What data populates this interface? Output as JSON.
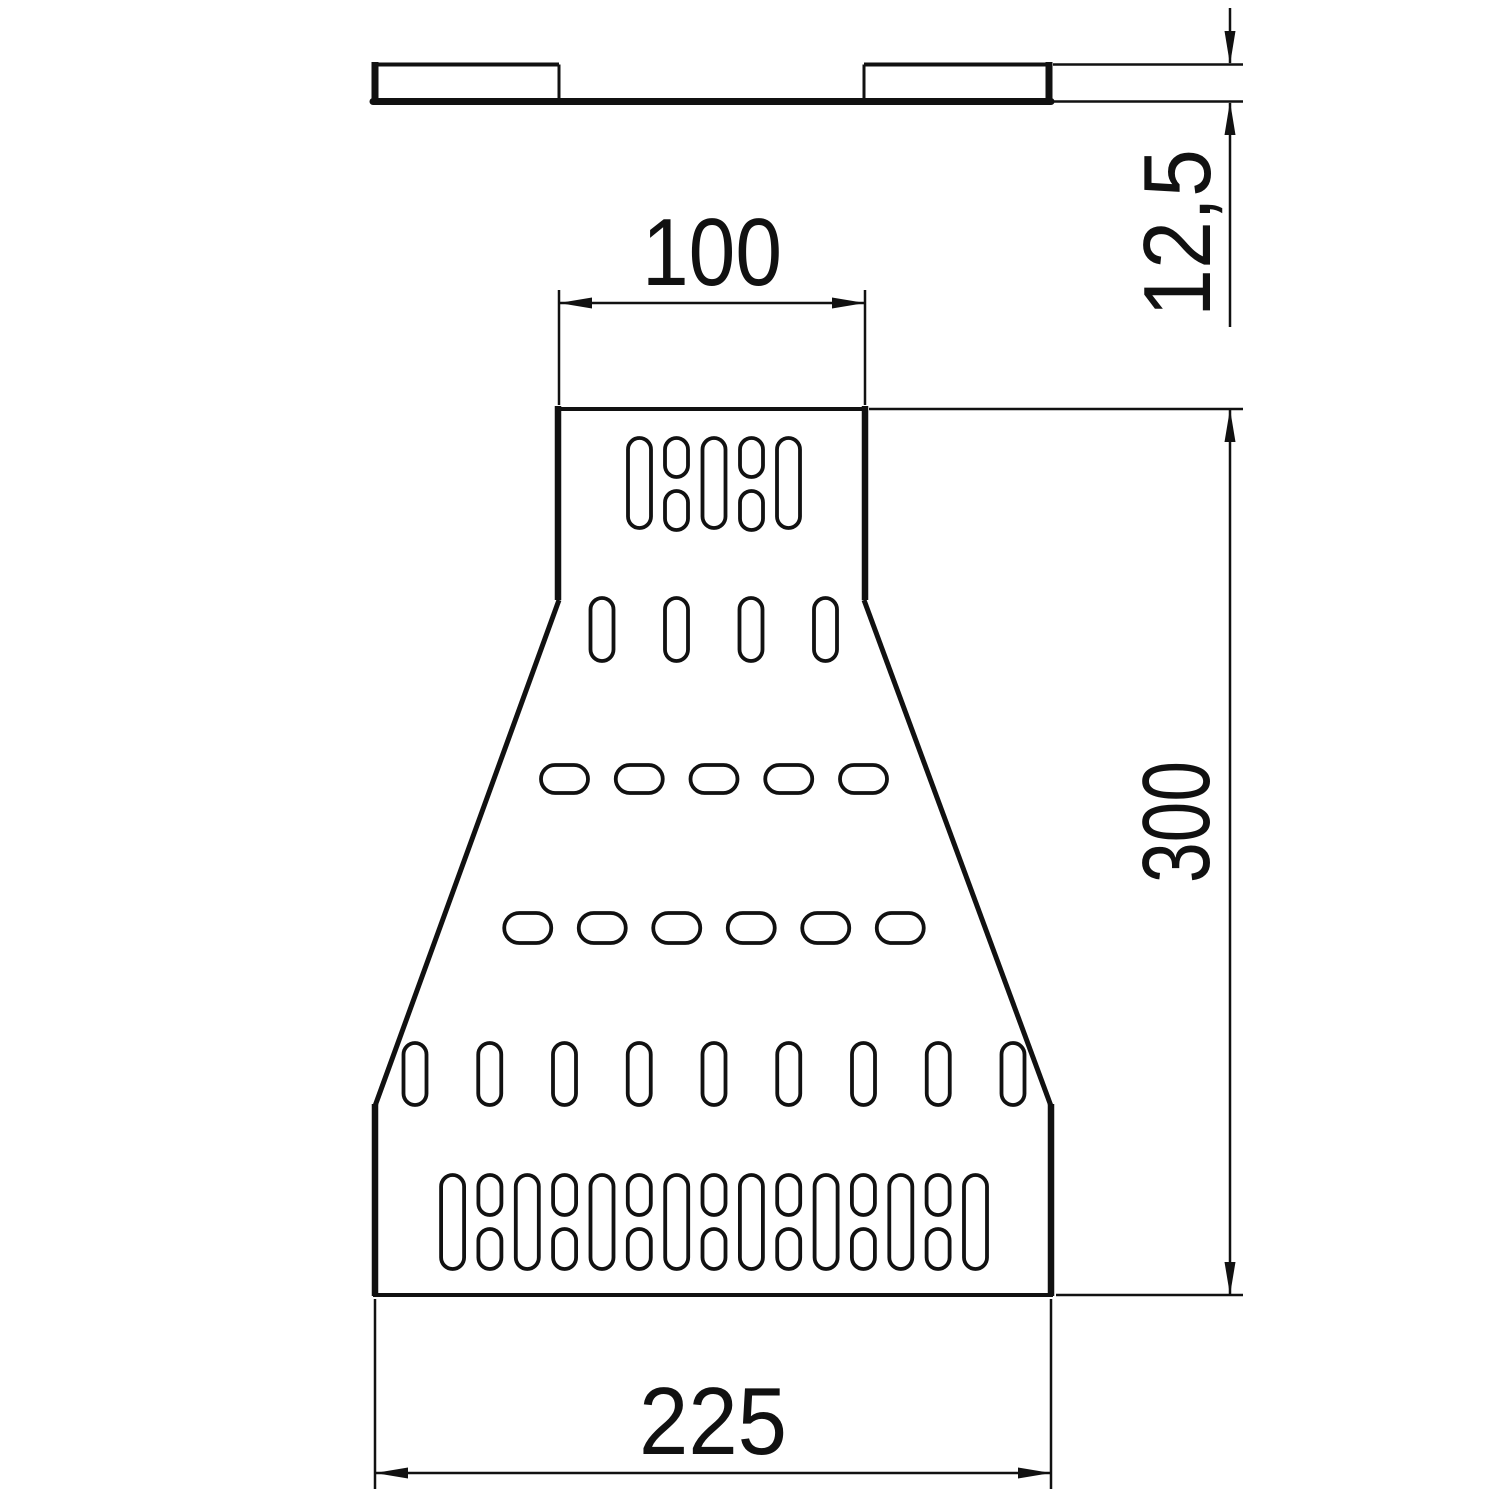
{
  "meta": {
    "drawing_type": "technical dimension drawing",
    "background_color": "#ffffff",
    "line_color": "#111111"
  },
  "side_view": {
    "description": "thin profile strip with raised rail at each end"
  },
  "plan_view": {
    "description": "perforated trapezoidal reducer plate with slotted holes"
  },
  "dimensions": {
    "top_width": {
      "label": "100"
    },
    "bottom_width": {
      "label": "225"
    },
    "height": {
      "label": "300"
    },
    "thickness": {
      "label": "12,5"
    }
  }
}
